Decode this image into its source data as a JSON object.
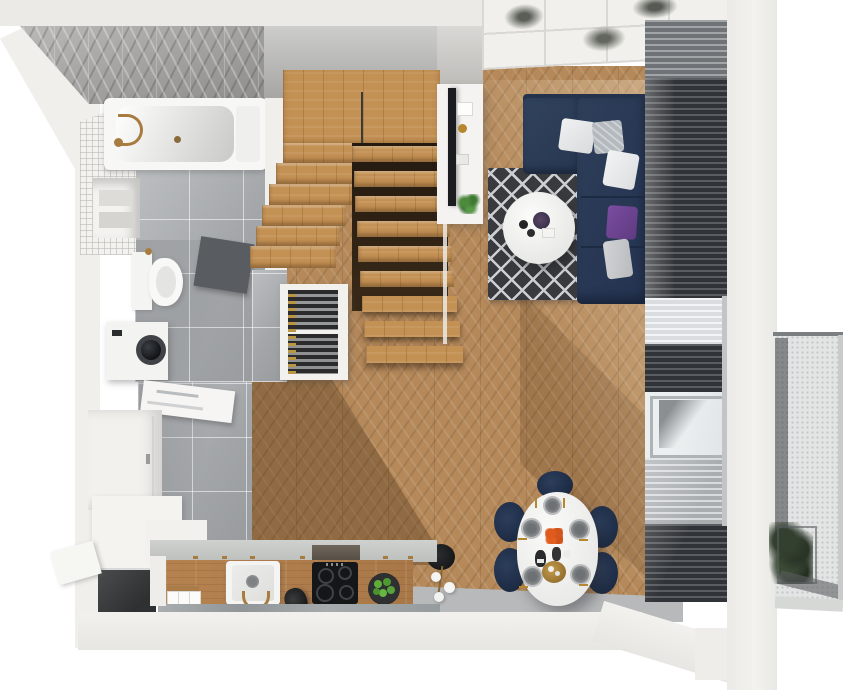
{
  "scene": {
    "label": "Apartment floor plan - top-down 3D render",
    "rooms": [
      {
        "id": "bathroom",
        "label": "Bathroom"
      },
      {
        "id": "hallway",
        "label": "Hallway"
      },
      {
        "id": "staircase",
        "label": "Staircase"
      },
      {
        "id": "living-room",
        "label": "Living room"
      },
      {
        "id": "dining-area",
        "label": "Dining area"
      },
      {
        "id": "kitchen",
        "label": "Kitchen"
      },
      {
        "id": "balcony",
        "label": "Balcony"
      }
    ],
    "objects": [
      "bathtub",
      "toilet",
      "washing-machine",
      "bath-mat",
      "wardrobe",
      "entry-door",
      "bathroom-door",
      "wood-stairs",
      "wine-rack",
      "tv-sideboard",
      "tv",
      "corner-sofa",
      "pillows",
      "diamond-rug",
      "coffee-table",
      "window-blinds",
      "sheer-curtains",
      "dining-table",
      "dining-chairs",
      "place-settings",
      "floor-lamp",
      "kitchen-counter",
      "sink",
      "induction-hob",
      "extractor-hood",
      "fruit-bowl",
      "canisters",
      "kettle",
      "balcony-plant",
      "ceiling-panels",
      "potted-plant"
    ]
  },
  "palette": {
    "background": "#ffffff",
    "wall": "#f0efeb",
    "wood_floor": "#b5895a",
    "stair_wood": "#c39154",
    "grey_tile": "#aaadb0",
    "sofa_navy": "#2a3b55",
    "rug_dark": "#393a3e",
    "pillow_purple": "#6d4190",
    "blinds_dark": "#33363a",
    "brass": "#b5872f",
    "flower_orange": "#dd5a1e",
    "plant_green": "#4f8a33",
    "hob_black": "#151618",
    "balcony_floor": "#e3e5e4",
    "marble": "#9fa4a6"
  }
}
